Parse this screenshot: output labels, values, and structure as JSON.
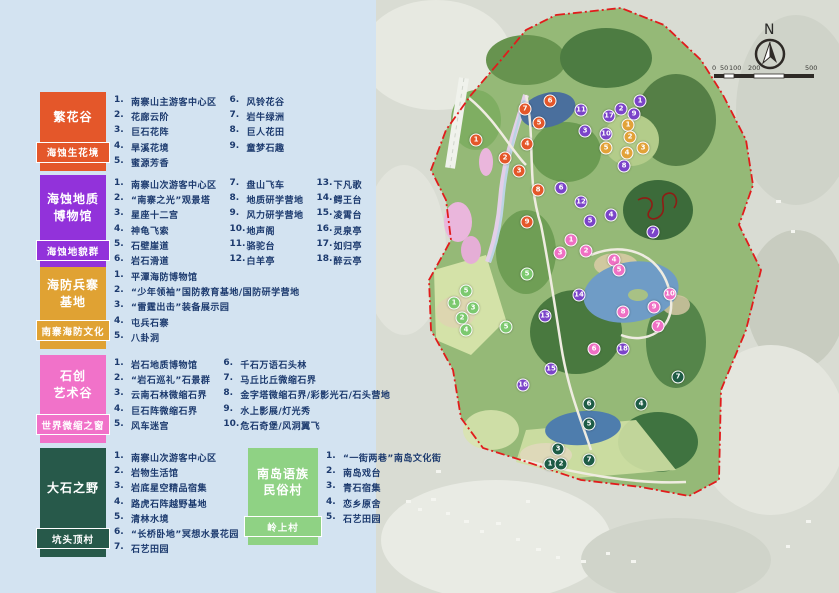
{
  "legend": {
    "groups": [
      {
        "title": "繁花谷",
        "subtitle": "海蚀生花境",
        "color": "#e4572a",
        "cols": 2,
        "items": [
          "南寨山主游客中心区",
          "花廊云阶",
          "巨石花阵",
          "旱溪花境",
          "蜜源芳香",
          "风铃花谷",
          "岩牛绿洲",
          "巨人花田",
          "童梦石趣"
        ]
      },
      {
        "title": "海蚀地质\n博物馆",
        "subtitle": "海蚀地貌群",
        "color": "#9232da",
        "cols": 3,
        "items": [
          "南寨山次游客中心区",
          "“南寨之光”观景塔",
          "星座十二宫",
          "神龟飞索",
          "石壁崖道",
          "岩石滑道",
          "盘山飞车",
          "地质研学营地",
          "风力研学营地",
          "地声阁",
          "骆驼台",
          "白羊亭",
          "下凡歌",
          "鳄王台",
          "凌霄台",
          "灵泉亭",
          "如归亭",
          "醉云亭"
        ]
      },
      {
        "title": "海防兵寨\n基地",
        "subtitle": "南寨海防文化",
        "color": "#e0a233",
        "cols": 1,
        "items": [
          "平潭海防博物馆",
          "“少年领袖”国防教育基地/国防研学营地",
          "“雷霆出击”装备展示园",
          "屯兵石寨",
          "八卦洞"
        ]
      },
      {
        "title": "石创\n艺术谷",
        "subtitle": "世界微缩之窗",
        "color": "#f172c9",
        "cols": 2,
        "items": [
          "岩石地质博物馆",
          "“岩石巡礼”石景群",
          "云南石林微缩石界",
          "巨石阵微缩石界",
          "风车迷宫",
          "千石万语石头林",
          "马丘比丘微缩石界",
          "金字塔微缩石界/彩影光石/石头营地",
          "水上影展/灯光秀",
          "危石奇堡/风洞翼飞"
        ]
      },
      {
        "title": "大石之野",
        "subtitle": "坑头顶村",
        "color": "#27594a",
        "cols": 1,
        "items": [
          "南寨山次游客中心区",
          "岩物生活馆",
          "岩底星空精品宿集",
          "路虎石阵越野基地",
          "清林水境",
          "“长桥卧地”冥想水景花园",
          "石艺田园"
        ]
      },
      {
        "title": "南岛语族\n民俗村",
        "subtitle": "岭上村",
        "color": "#8fd284",
        "cols": 1,
        "items": [
          "“一街两巷”南岛文化街",
          "南岛戏台",
          "青石宿集",
          "恋乡原舍",
          "石艺田园"
        ]
      }
    ]
  },
  "map": {
    "north_label": "N",
    "scale_labels": [
      "0",
      "50",
      "100",
      "200",
      "500"
    ],
    "boundary_color": "#e11c1c",
    "marker_sets": [
      {
        "name": "flower-valley",
        "color": "#e4572a",
        "points": [
          {
            "n": 1,
            "x": 100,
            "y": 140
          },
          {
            "n": 2,
            "x": 129,
            "y": 158
          },
          {
            "n": 3,
            "x": 143,
            "y": 171
          },
          {
            "n": 4,
            "x": 151,
            "y": 144
          },
          {
            "n": 5,
            "x": 163,
            "y": 123
          },
          {
            "n": 6,
            "x": 174,
            "y": 101
          },
          {
            "n": 7,
            "x": 149,
            "y": 109
          },
          {
            "n": 8,
            "x": 162,
            "y": 190
          },
          {
            "n": 9,
            "x": 151,
            "y": 222
          }
        ]
      },
      {
        "name": "geology-museum",
        "color": "#7b44c9",
        "points": [
          {
            "n": 1,
            "x": 264,
            "y": 101
          },
          {
            "n": 2,
            "x": 245,
            "y": 109
          },
          {
            "n": 3,
            "x": 209,
            "y": 131
          },
          {
            "n": 4,
            "x": 235,
            "y": 215
          },
          {
            "n": 5,
            "x": 214,
            "y": 221
          },
          {
            "n": 6,
            "x": 185,
            "y": 188
          },
          {
            "n": 7,
            "x": 277,
            "y": 232
          },
          {
            "n": 8,
            "x": 248,
            "y": 166
          },
          {
            "n": 9,
            "x": 258,
            "y": 114
          },
          {
            "n": 10,
            "x": 230,
            "y": 134
          },
          {
            "n": 11,
            "x": 205,
            "y": 110
          },
          {
            "n": 12,
            "x": 205,
            "y": 202
          },
          {
            "n": 13,
            "x": 169,
            "y": 316
          },
          {
            "n": 14,
            "x": 203,
            "y": 295
          },
          {
            "n": 15,
            "x": 175,
            "y": 369
          },
          {
            "n": 16,
            "x": 147,
            "y": 385
          },
          {
            "n": 17,
            "x": 233,
            "y": 116
          },
          {
            "n": 18,
            "x": 247,
            "y": 349
          }
        ]
      },
      {
        "name": "defense-base",
        "color": "#e2a238",
        "points": [
          {
            "n": 1,
            "x": 252,
            "y": 125
          },
          {
            "n": 2,
            "x": 254,
            "y": 137
          },
          {
            "n": 3,
            "x": 267,
            "y": 148
          },
          {
            "n": 4,
            "x": 251,
            "y": 153
          },
          {
            "n": 5,
            "x": 230,
            "y": 148
          }
        ]
      },
      {
        "name": "stone-art-valley",
        "color": "#ef70c4",
        "points": [
          {
            "n": 1,
            "x": 195,
            "y": 240
          },
          {
            "n": 2,
            "x": 210,
            "y": 251
          },
          {
            "n": 3,
            "x": 184,
            "y": 253
          },
          {
            "n": 4,
            "x": 238,
            "y": 260
          },
          {
            "n": 5,
            "x": 243,
            "y": 270
          },
          {
            "n": 6,
            "x": 218,
            "y": 349
          },
          {
            "n": 7,
            "x": 282,
            "y": 326
          },
          {
            "n": 8,
            "x": 247,
            "y": 312
          },
          {
            "n": 9,
            "x": 278,
            "y": 307
          },
          {
            "n": 10,
            "x": 294,
            "y": 294
          }
        ]
      },
      {
        "name": "stone-wilderness",
        "color": "#1e5c46",
        "points": [
          {
            "n": 1,
            "x": 174,
            "y": 464
          },
          {
            "n": 2,
            "x": 185,
            "y": 464
          },
          {
            "n": 3,
            "x": 182,
            "y": 449
          },
          {
            "n": 4,
            "x": 265,
            "y": 404
          },
          {
            "n": 5,
            "x": 213,
            "y": 424
          },
          {
            "n": 6,
            "x": 213,
            "y": 404
          },
          {
            "n": 7,
            "x": 213,
            "y": 460
          },
          {
            "n": 7,
            "x": 302,
            "y": 377
          }
        ]
      },
      {
        "name": "folk-village",
        "color": "#7cc96f",
        "points": [
          {
            "n": 1,
            "x": 78,
            "y": 303
          },
          {
            "n": 2,
            "x": 86,
            "y": 318
          },
          {
            "n": 3,
            "x": 97,
            "y": 308
          },
          {
            "n": 4,
            "x": 90,
            "y": 330
          },
          {
            "n": 5,
            "x": 151,
            "y": 274
          },
          {
            "n": 5,
            "x": 90,
            "y": 291
          },
          {
            "n": 5,
            "x": 130,
            "y": 327
          }
        ]
      }
    ]
  }
}
